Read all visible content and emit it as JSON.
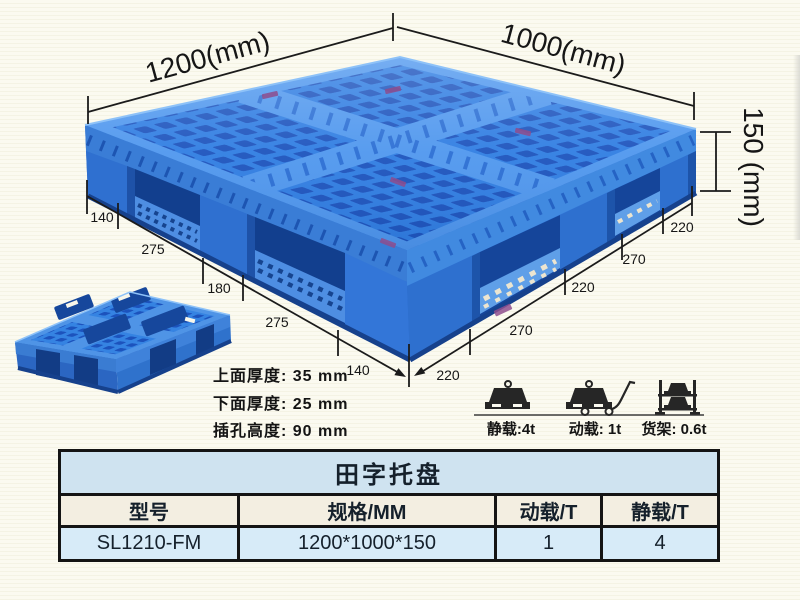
{
  "illustration": {
    "length_label": "1200(mm)",
    "width_label": "1000(mm)",
    "height_label": "150 (mm)",
    "left_edge_segments": [
      "140",
      "275",
      "180",
      "275",
      "140"
    ],
    "right_edge_segments": [
      "220",
      "270",
      "220",
      "270",
      "220"
    ]
  },
  "specs": {
    "top_thickness": "上面厚度: 35 mm",
    "bottom_thickness": "下面厚度: 25 mm",
    "fork_hole_height": "插孔高度: 90 mm"
  },
  "capacity": {
    "static": "静载:4t",
    "dynamic": "动载: 1t",
    "rack": "货架: 0.6t"
  },
  "table": {
    "title": "田字托盘",
    "headers": [
      "型号",
      "规格/MM",
      "动载/T",
      "静载/T"
    ],
    "row": [
      "SL1210-FM",
      "1200*1000*150",
      "1",
      "4"
    ]
  },
  "colors": {
    "pallet_blue": "#2f7de2",
    "pallet_hole_blue": "#1c53bd",
    "pallet_light_blue": "#5e9ce8",
    "dimension_line": "#1b1b1b",
    "table_title_bg": "#cfe3f0",
    "table_header_bg": "#f3eee1",
    "table_data_bg": "#d7ebf8"
  }
}
